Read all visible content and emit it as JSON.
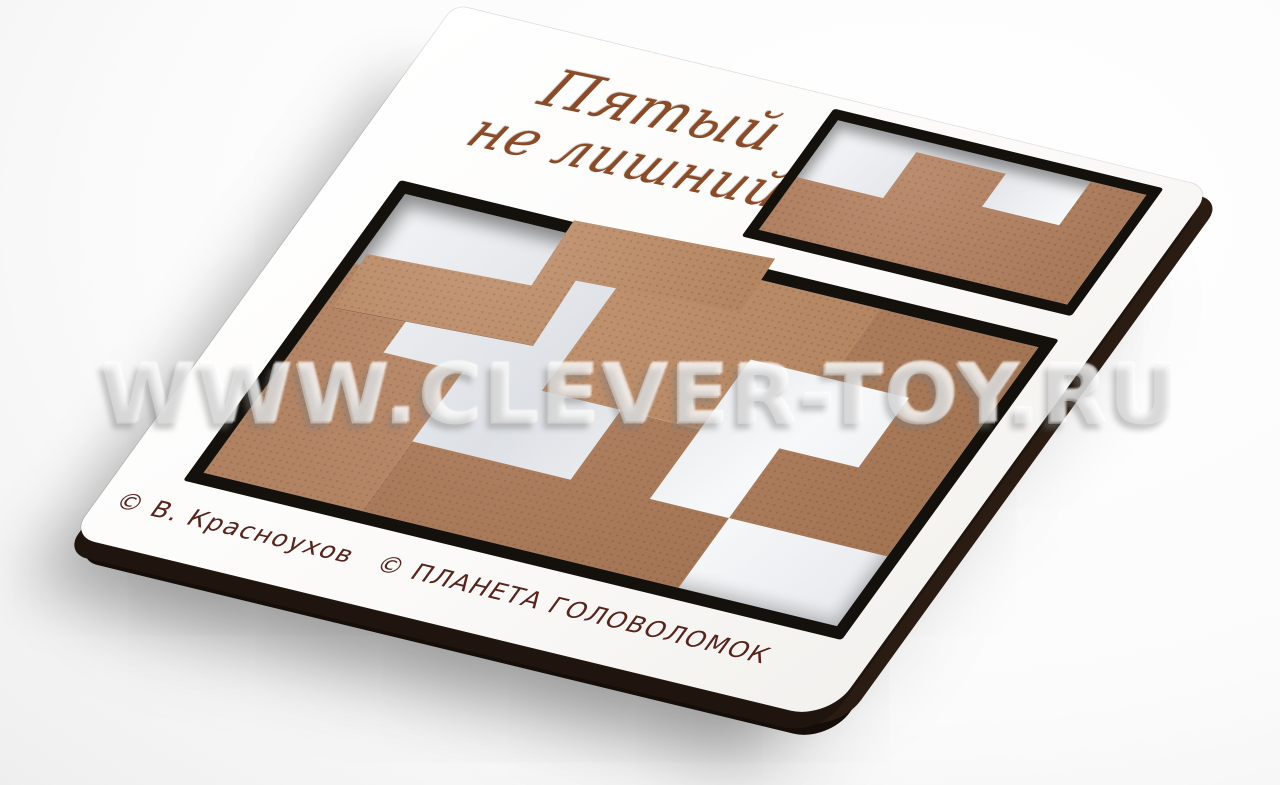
{
  "photo": {
    "description_tag": "wooden-puzzle-product-photo",
    "watermark": {
      "text": "WWW.CLEVER-TOY.RU"
    },
    "board": {
      "title": {
        "line1": "Пятый",
        "line2": "не лишний"
      },
      "credits": {
        "author": "© В. Красноухов",
        "publisher": "© ПЛАНЕТА ГОЛОВОЛОМОК"
      },
      "pieces": {
        "material": "MDF wood",
        "in_main_tray": [
          "top-piece",
          "right-piece",
          "left-piece",
          "bottom-piece"
        ],
        "raised_piece": "zigzag-piece-on-top",
        "parking_piece": "notched-piece-top-right"
      }
    }
  },
  "colors": {
    "board_face": "#fbfaf8",
    "board_edge": "#1f150e",
    "piece_wood": "#b3805e",
    "tray_backing": "#eceef1",
    "cut_line": "#14100b",
    "engraving": "#8a4c28",
    "credits_text": "#56241d",
    "background": "#ffffff"
  }
}
